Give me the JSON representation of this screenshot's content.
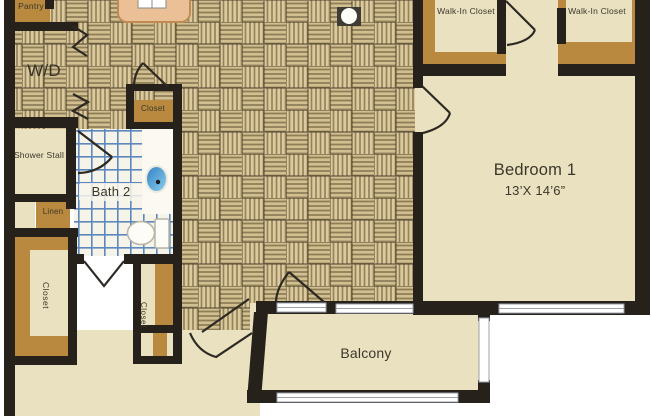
{
  "title": "Apartment floor plan",
  "rooms": {
    "pantry": {
      "label": "Pantry"
    },
    "washer_dryer": {
      "label": "W/D"
    },
    "walk_in_closet_1": {
      "label": "Walk-In Closet"
    },
    "walk_in_closet_2": {
      "label": "Walk-In Closet"
    },
    "hall_closet": {
      "label": "Closet"
    },
    "shower_stall": {
      "label": "Shower Stall"
    },
    "bath2": {
      "label": "Bath 2"
    },
    "linen": {
      "label": "Linen"
    },
    "closet_left": {
      "label": "Closet"
    },
    "closet_narrow": {
      "label": "Closet"
    },
    "living": {
      "label": "Living",
      "dimensions": "14’ X 17’5”"
    },
    "bedroom1": {
      "label": "Bedroom 1",
      "dimensions": "13’X 14’6”"
    },
    "balcony": {
      "label": "Balcony"
    }
  },
  "colors": {
    "floor_cream": "#eae1c1",
    "accent_tan": "#b8893e",
    "wall": "#26211b",
    "parquet_base": "#dcca9c",
    "tile_line_blue": "#5d88bd",
    "island_peach": "#ecc096",
    "sink_blue": "#3e98d3"
  }
}
